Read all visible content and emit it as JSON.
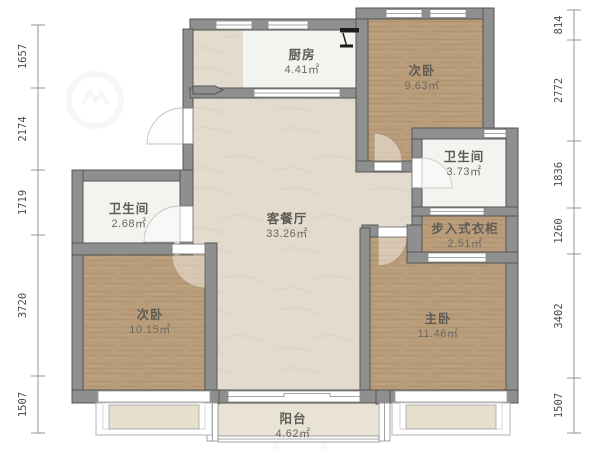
{
  "plan_title": "三室两卫户型图",
  "rooms": [
    {
      "id": "kitchen",
      "name": "厨房",
      "area": "4.41㎡"
    },
    {
      "id": "bedroom-top-right",
      "name": "次卧",
      "area": "9.63㎡"
    },
    {
      "id": "bathroom-right",
      "name": "卫生间",
      "area": "3.73㎡"
    },
    {
      "id": "walk-in-closet",
      "name": "步入式衣柜",
      "area": "2.51㎡"
    },
    {
      "id": "living-dining",
      "name": "客餐厅",
      "area": "33.26㎡"
    },
    {
      "id": "bathroom-left",
      "name": "卫生间",
      "area": "2.68㎡"
    },
    {
      "id": "bedroom-bottom-left",
      "name": "次卧",
      "area": "10.15㎡"
    },
    {
      "id": "master-bedroom",
      "name": "主卧",
      "area": "11.46㎡"
    },
    {
      "id": "balcony",
      "name": "阳台",
      "area": "4.62㎡"
    }
  ],
  "dims": {
    "left": [
      "1657",
      "2174",
      "1719",
      "3720",
      "1507"
    ],
    "right": [
      "814",
      "2772",
      "1836",
      "1260",
      "3402",
      "1507"
    ]
  },
  "colors": {
    "wall": "#8f8f8f",
    "wall_edge": "#545454",
    "wood_floor": "#b99d7a",
    "living_floor": "#e2dbce",
    "wet_floor": "#f3f3f0",
    "balcony_floor": "#e9e3d6",
    "bay_fill": "#e6dfcd",
    "dimension_text": "#4a4a4a"
  }
}
